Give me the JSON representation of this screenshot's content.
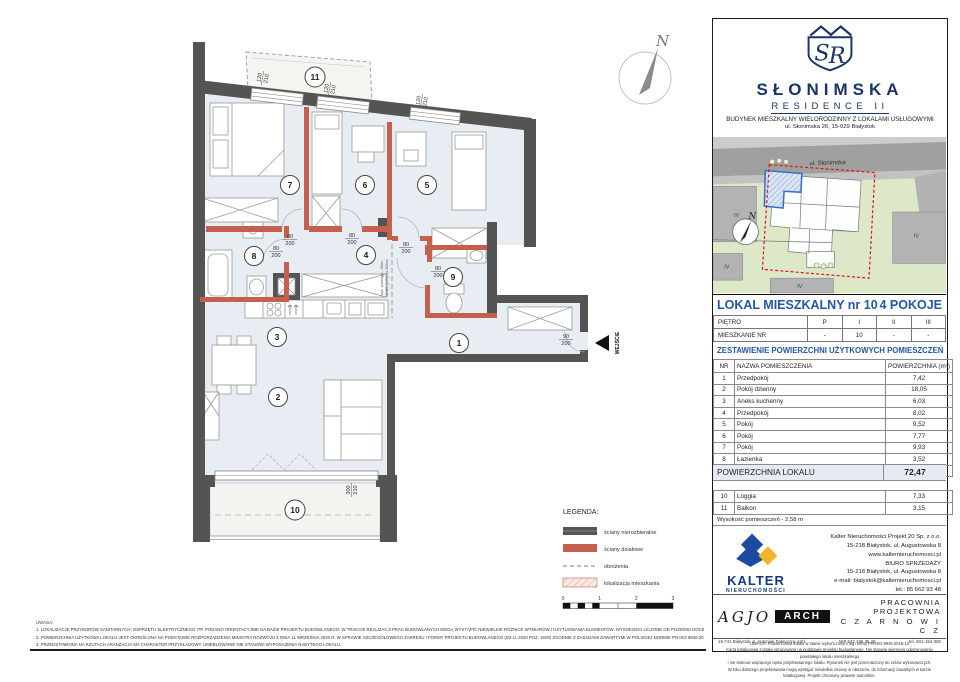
{
  "header": {
    "monogram": "SR",
    "brand": "SŁONIMSKA",
    "brand_sub": "RESIDENCE II",
    "line1": "BUDYNEK MIESZKALNY WIELORODZINNY Z LOKALAMI USŁUGOWYMI",
    "line2": "ul. Słonimska 26, 15-029 Białystok"
  },
  "map": {
    "street": "ul. Słonimska",
    "north": "N",
    "floor_labels": [
      "IV",
      "IV",
      "IV",
      "IV"
    ]
  },
  "unit": {
    "title": "LOKAL MIESZKALNY  nr 10",
    "type": "4 POKOJE"
  },
  "floor_table": {
    "row1_label": "PIĘTRO",
    "row1": [
      "P",
      "I",
      "II",
      "III"
    ],
    "row2_label": "MIESZKANIE NR",
    "row2": [
      "-",
      "10",
      "-",
      "-"
    ]
  },
  "area": {
    "title": "ZESTAWIENIE POWIERZCHNI UŻYTKOWYCH POMIESZCZEŃ",
    "headers": [
      "NR",
      "NAZWA POMIESZCZENIA",
      "POWIERZCHNIA (m²)"
    ],
    "rows": [
      [
        "1",
        "Przedpokój",
        "7,42"
      ],
      [
        "2",
        "Pokój dzienny",
        "18,05"
      ],
      [
        "3",
        "Aneks kuchenny",
        "6,03"
      ],
      [
        "4",
        "Przedpokój",
        "8,02"
      ],
      [
        "5",
        "Pokój",
        "9,52"
      ],
      [
        "6",
        "Pokój",
        "7,77"
      ],
      [
        "7",
        "Pokój",
        "9,93"
      ],
      [
        "8",
        "Łazienka",
        "3,52"
      ],
      [
        "9",
        "WC",
        "2,21"
      ]
    ],
    "total_label": "POWIERZCHNIA LOKALU",
    "total_value": "72,47",
    "extra_rows": [
      [
        "10",
        "Loggia",
        "7,33"
      ],
      [
        "11",
        "Balkon",
        "3,15"
      ]
    ],
    "height_note": "Wysokość pomieszczeń - 2,58 m"
  },
  "developer": {
    "name": "KALTER",
    "sub": "NIERUCHOMOŚCI",
    "lines": [
      "Kalter Nieruchomości Projekt 20  Sp. z o.o.",
      "15-218 Białystok, ul. Augustowska 8",
      "www.kalternieruchomosci.pl",
      "BIURO SPRZEDAŻY",
      "15-218 Białystok, ul. Augustowska 8",
      "e-mail: bialystok@kalternieruchomosci.pl",
      "tel.: 85 662 93 48"
    ]
  },
  "studio": {
    "agjo": "AGJO",
    "arch": "ARCH",
    "address": "15-741 Białystok    ul. Antoniuk Fabryczny    12/1",
    "name1": "PRACOWNIA PROJEKTOWA",
    "name2": "C Z A R N O W I C Z",
    "nip": "NIP   542 196 35 28",
    "tel": "tel. 501-154-360"
  },
  "disclaimer": {
    "lines": [
      "UWAGA:   Powierzchnia lokalu w stanie wykończonym wg normy PN-ISO 9836:2015-12",
      "Karta katalogowa została opracowana na podstawie projektu budowlanego.  Nie stanowi wiernego odwzorowania powstałego lokalu mieszkalnego",
      "i nie stanowi wiążącego opisu projektowanego lokalu. Rysunek nie jest przeznaczony do celów wykonawczych.",
      "W toku dalszego projektowania mogą wystąpić niewielkie zmiany w obszarze, do informacji zawartych w karcie katalogowej. Projekt chroniony prawem autorskim."
    ]
  },
  "plan": {
    "rooms": [
      "1",
      "2",
      "3",
      "4",
      "5",
      "6",
      "7",
      "8",
      "9",
      "10",
      "11"
    ],
    "dims": {
      "win_w": "120",
      "win_h": "210",
      "door_w": "80",
      "door_h": "200",
      "entr_w": "90",
      "entr_h": "200",
      "log_w": "300",
      "log_h": "210"
    },
    "entrance_label": "WEJŚCIE",
    "north": "N",
    "beam_note1": "wys. podciągu - 26cm",
    "beam_note2": "światło przejścia 200cm",
    "legend": {
      "title": "LEGENDA:",
      "items": [
        "ściany nierozbieralne",
        "ściany działowe",
        "obniżenia",
        "lokalizacja mieszkania"
      ]
    },
    "scale": [
      "0",
      "1",
      "2",
      "3"
    ]
  },
  "notes": {
    "title": "UWAGA:",
    "items": [
      "1.     LOKALIZACJE PRZYBORÓW SANITARNYCH, OSPRZĘTU ELEKTRYCZNEGO ITP. PODANO ORIENTACYJNIE NA BAZIE PROJEKTU BUDOWLANEGO. W TRAKCIE REALIZACJI PRAC BUDOWLANYCH MOGĄ WYSTĄPIĆ NIEWIELKIE RÓŻNICE WYMIARÓW I USYTUOWANIA ELEMENTÓW. WYSOKOŚCI LICZONE OD POZIOMU DOCELOWEGO WYKOŃCZENIA PODŁÓG.",
      "2.     POWIERZCHNIA UŻYTKOWA LOKALU JEST OKREŚLONA NA PODSTAWIE ROZPORZĄDZENIA MINISTRA ROZWOJU Z DNIA 11 WRZEŚNIA 2020 R. W SPRAWIE SZCZEGÓŁOWEGO ZAKRESU I FORMY PROJEKTU BUDOWLANEGO (DZ.U. 2020 POZ. 1609) ZGODNIE Z ZASADAMI ZAWARTYMI W POLSKIEJ NORMIE PN-ISO 9836:2015-12",
      "3.     PRZEDSTAWIONA NA RZUTACH ARANŻACJA MA CHARAKTER PRZYKŁADOWY. UMEBLOWANIE NIE STANOWI WYPOSAŻENIA NABYTEGO LOKALU."
    ]
  }
}
